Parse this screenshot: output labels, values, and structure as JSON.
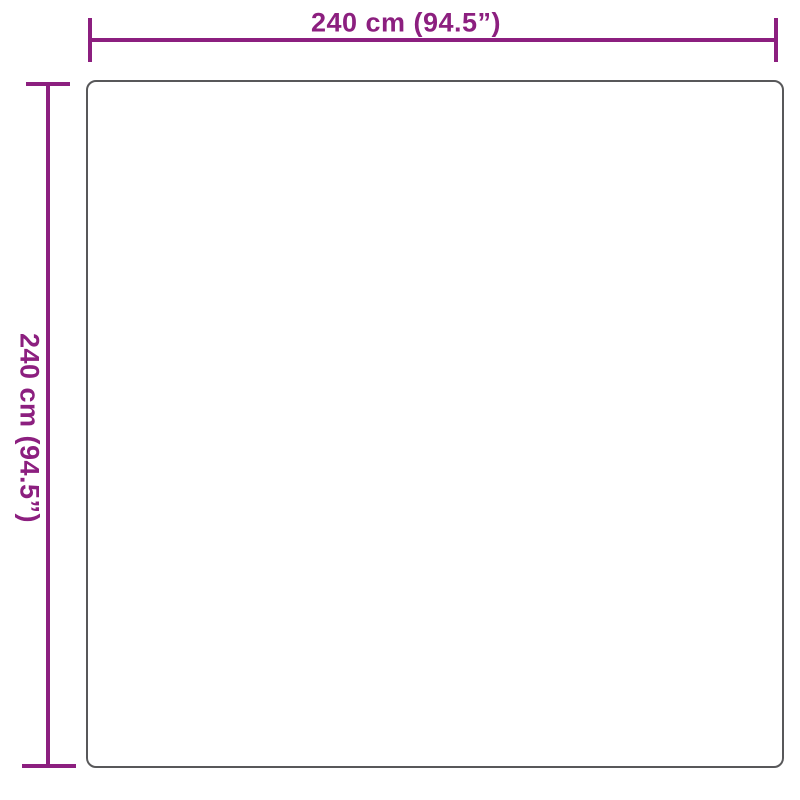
{
  "diagram": {
    "horizontal_dimension": {
      "label": "240 cm (94.5”)"
    },
    "vertical_dimension": {
      "label": "240 cm (94.5”)"
    },
    "colors": {
      "dimension_accent": "#8C1F7F",
      "outline": "#58585A",
      "background": "#FFFFFF"
    }
  }
}
